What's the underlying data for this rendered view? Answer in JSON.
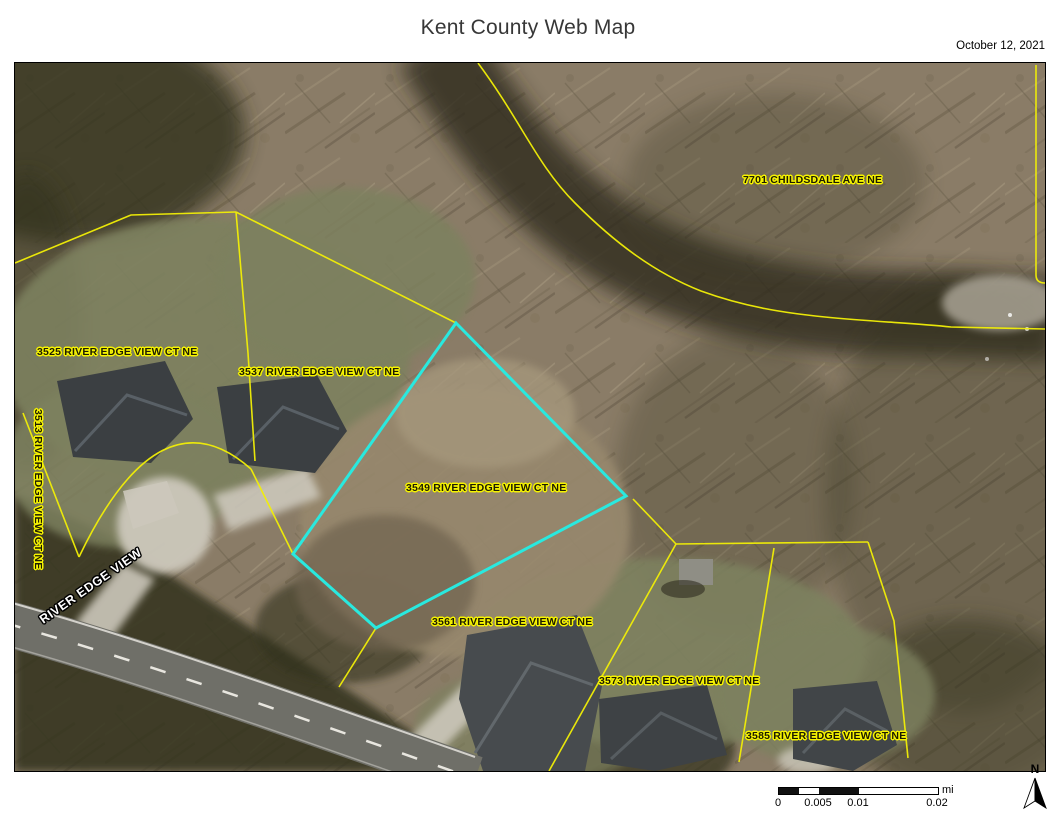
{
  "page": {
    "title": "Kent County Web Map",
    "date": "October 12, 2021"
  },
  "map": {
    "labels": [
      {
        "text": "7701 CHILDSDALE AVE NE"
      },
      {
        "text": "3525 RIVER EDGE VIEW CT NE"
      },
      {
        "text": "3537 RIVER EDGE VIEW CT NE"
      },
      {
        "text": "3549 RIVER EDGE VIEW CT NE"
      },
      {
        "text": "3561 RIVER EDGE VIEW CT NE"
      },
      {
        "text": "3573 RIVER EDGE VIEW CT NE"
      },
      {
        "text": "3585 RIVER EDGE VIEW CT NE"
      },
      {
        "text": "3513 RIVER EDGE VIEW CT NE"
      }
    ],
    "road_label": "RIVER EDGE VIEW",
    "colors": {
      "parcel_line": "#f2ef06",
      "highlight_parcel": "#29e9df",
      "label_halo": "#f6f300"
    }
  },
  "scalebar": {
    "ticks": [
      "0",
      "0.005",
      "0.01",
      "0.02"
    ],
    "unit": "mi"
  },
  "north_arrow": {
    "label": "N"
  }
}
